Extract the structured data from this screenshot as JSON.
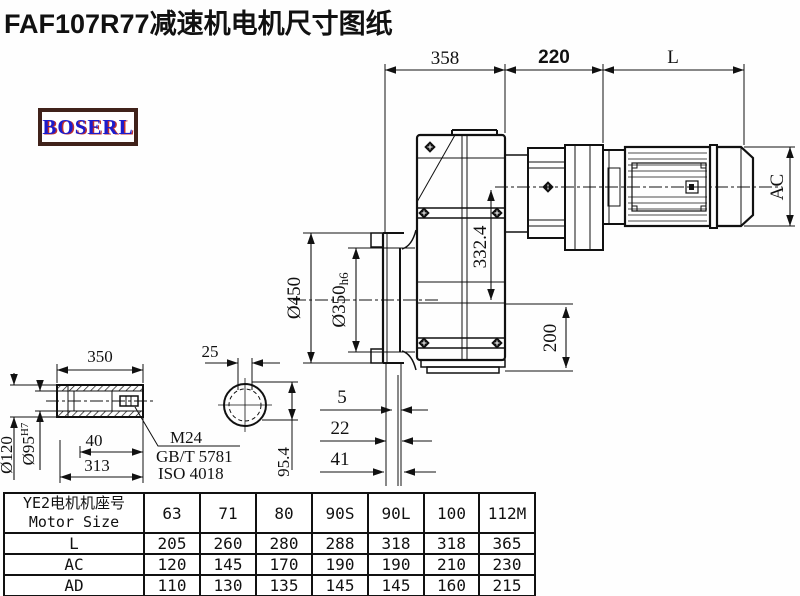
{
  "title": "FAF107R77减速机电机尺寸图纸",
  "logo": {
    "text": "BOSERL"
  },
  "drawing": {
    "dims": {
      "d358": "358",
      "d220": "220",
      "dL": "L",
      "dAC": "AC",
      "d332": "332.4",
      "d200": "200",
      "d450": "Ø450",
      "d350": "Ø350",
      "d350suf": "h6",
      "d5": "5",
      "d22": "22",
      "d41": "41",
      "s350": "350",
      "s25": "25",
      "s120": "Ø120",
      "s95": "Ø95",
      "s95sup": "H7",
      "s40": "40",
      "s313": "313",
      "s954": "95.4"
    },
    "notes": {
      "thread": "M24",
      "std1": "GB/T 5781",
      "std2": "ISO 4018"
    }
  },
  "table": {
    "header_cn": "YE2电机机座号",
    "header_en": "Motor Size",
    "columns": [
      "63",
      "71",
      "80",
      "90S",
      "90L",
      "100",
      "112M"
    ],
    "rows": [
      {
        "label": "L",
        "values": [
          "205",
          "260",
          "280",
          "288",
          "318",
          "318",
          "365"
        ]
      },
      {
        "label": "AC",
        "values": [
          "120",
          "145",
          "170",
          "190",
          "190",
          "210",
          "230"
        ]
      },
      {
        "label": "AD",
        "values": [
          "110",
          "130",
          "135",
          "145",
          "145",
          "160",
          "215"
        ]
      }
    ]
  }
}
